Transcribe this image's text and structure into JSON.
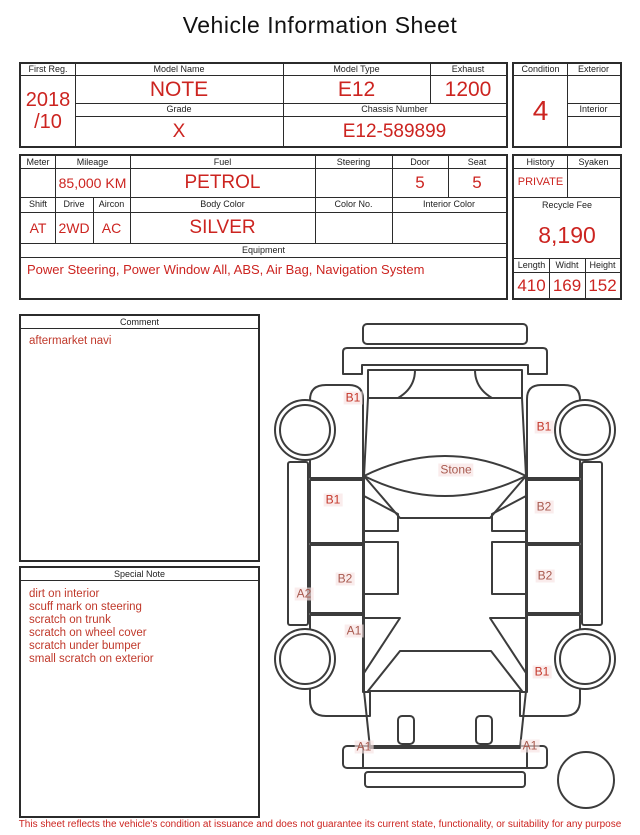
{
  "colors": {
    "accent": "#cc2420",
    "ink": "#1a1a1a",
    "line": "#2b2b2b",
    "bright": "#c4372a",
    "soft": "#a85a4f"
  },
  "title": "Vehicle Information Sheet",
  "registration": {
    "first_reg_label": "First Reg.",
    "first_reg_year": "2018",
    "first_reg_month": "/10",
    "model_name_label": "Model Name",
    "model_name": "NOTE",
    "model_type_label": "Model Type",
    "model_type": "E12",
    "exhaust_label": "Exhaust",
    "exhaust": "1200",
    "grade_label": "Grade",
    "grade": "X",
    "chassis_label": "Chassis Number",
    "chassis_number": "E12-589899"
  },
  "condition": {
    "condition_label": "Condition",
    "condition_value": "4",
    "exterior_label": "Exterior",
    "interior_label": "Interior"
  },
  "specs": {
    "meter_label": "Meter",
    "mileage_label": "Mileage",
    "mileage_value": "85,000 KM",
    "fuel_label": "Fuel",
    "fuel_value": "PETROL",
    "steering_label": "Steering",
    "door_label": "Door",
    "door_value": "5",
    "seat_label": "Seat",
    "seat_value": "5",
    "shift_label": "Shift",
    "shift_value": "AT",
    "drive_label": "Drive",
    "drive_value": "2WD",
    "aircon_label": "Aircon",
    "aircon_value": "AC",
    "body_color_label": "Body Color",
    "body_color_value": "SILVER",
    "color_no_label": "Color No.",
    "interior_color_label": "Interior Color",
    "equipment_label": "Equipment",
    "equipment_value": "Power Steering, Power Window  All, ABS, Air Bag, Navigation System"
  },
  "admin": {
    "history_label": "History",
    "history_value": "PRIVATE",
    "syaken_label": "Syaken",
    "recycle_fee_label": "Recycle Fee",
    "recycle_fee_value": "8,190",
    "length_label": "Length",
    "widht_label": "Widht",
    "height_label": "Height",
    "length_value": "410",
    "width_value": "169",
    "height_value": "152"
  },
  "comment": {
    "label": "Comment",
    "text": "aftermarket navi"
  },
  "special_note": {
    "label": "Special Note",
    "lines": [
      "dirt on interior",
      "scuff mark on steering",
      "scratch on trunk",
      "scratch on wheel cover",
      "scratch under bumper",
      "small scratch on exterior"
    ]
  },
  "diagram": {
    "markers": [
      {
        "label": "B1",
        "x": 83,
        "y": 88,
        "tone": "bright",
        "area": "front-left-fender"
      },
      {
        "label": "B1",
        "x": 274,
        "y": 117,
        "tone": "bright",
        "area": "front-right-fender"
      },
      {
        "label": "Stone",
        "x": 186,
        "y": 160,
        "tone": "soft",
        "area": "windshield"
      },
      {
        "label": "B1",
        "x": 63,
        "y": 190,
        "tone": "bright",
        "area": "front-left-door"
      },
      {
        "label": "B2",
        "x": 274,
        "y": 197,
        "tone": "soft",
        "area": "front-right-door"
      },
      {
        "label": "B2",
        "x": 75,
        "y": 269,
        "tone": "soft",
        "area": "rear-left-door"
      },
      {
        "label": "B2",
        "x": 275,
        "y": 266,
        "tone": "soft",
        "area": "rear-right-door"
      },
      {
        "label": "A2",
        "x": 34,
        "y": 284,
        "tone": "soft",
        "area": "left-sill"
      },
      {
        "label": "A1",
        "x": 84,
        "y": 321,
        "tone": "soft",
        "area": "rear-left-quarter"
      },
      {
        "label": "B1",
        "x": 272,
        "y": 362,
        "tone": "bright",
        "area": "rear-right-quarter"
      },
      {
        "label": "A1",
        "x": 94,
        "y": 437,
        "tone": "soft",
        "area": "rear-bumper-left"
      },
      {
        "label": "A1",
        "x": 260,
        "y": 436,
        "tone": "soft",
        "area": "rear-bumper-right"
      }
    ]
  },
  "footer": "This sheet reflects the vehicle's condition at issuance and does not guarantee its current state, functionality, or suitability for any purpose"
}
